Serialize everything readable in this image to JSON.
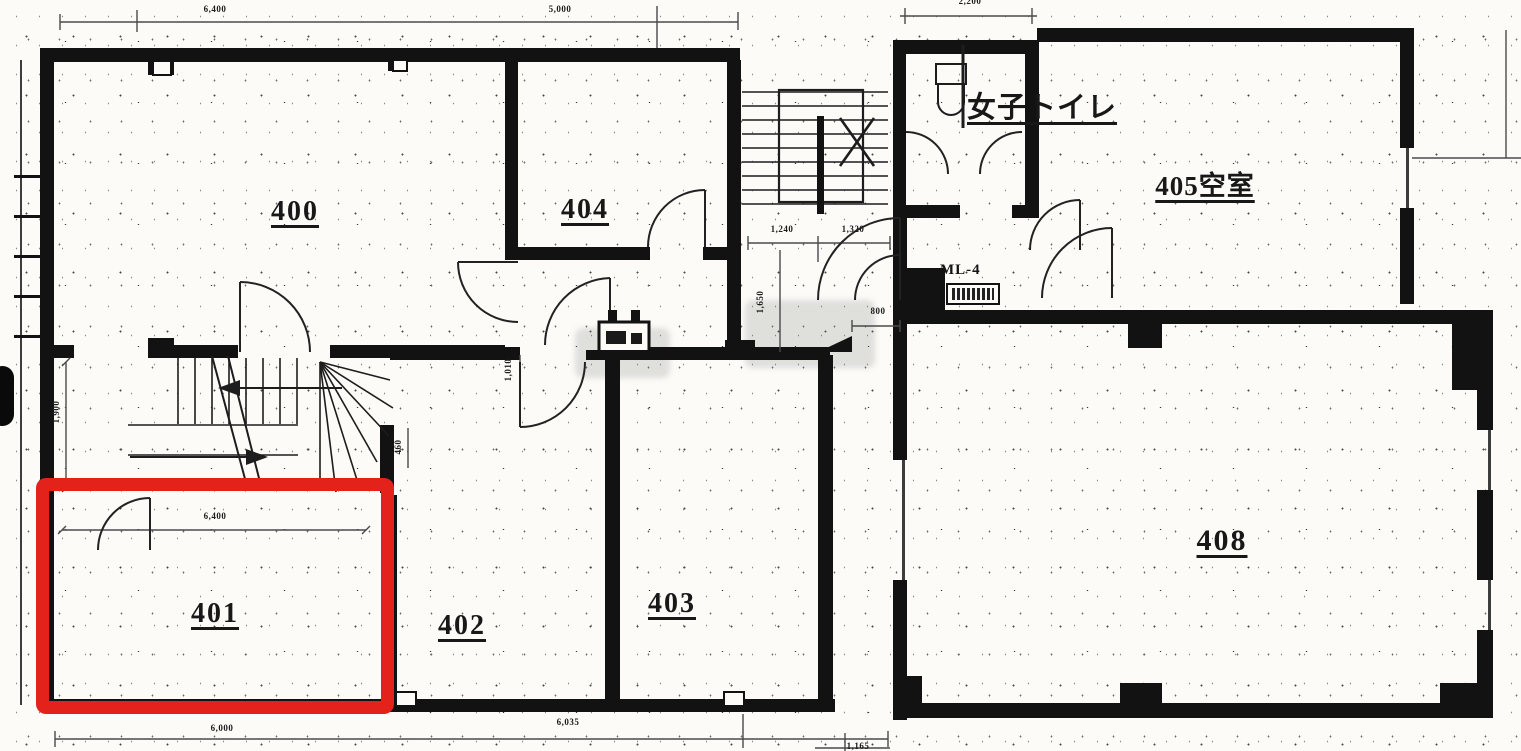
{
  "plan": {
    "title": "4F floor plan",
    "wall_color": "#121212",
    "highlight_color": "#e3231b",
    "highlighted_room": "401"
  },
  "rooms": [
    {
      "label": "400"
    },
    {
      "label": "404"
    },
    {
      "label": "405空室"
    },
    {
      "label": "女子トイレ"
    },
    {
      "label": "401"
    },
    {
      "label": "402"
    },
    {
      "label": "403"
    },
    {
      "label": "408"
    }
  ],
  "equipment": {
    "ml4": "ML-4"
  },
  "dims": {
    "top_left": "6,400",
    "top_mid": "5,000",
    "top_right": "2,200",
    "bottom_left": "6,000",
    "bottom_mid": "6,035",
    "bottom_right": "1,165",
    "stair_left": "1,240",
    "stair_right": "1,320",
    "left_height": "1,900",
    "corridor_height": "1,650",
    "hall_height": "1,010",
    "niche": "460",
    "lobby": "800",
    "room401_width": "6,400"
  }
}
